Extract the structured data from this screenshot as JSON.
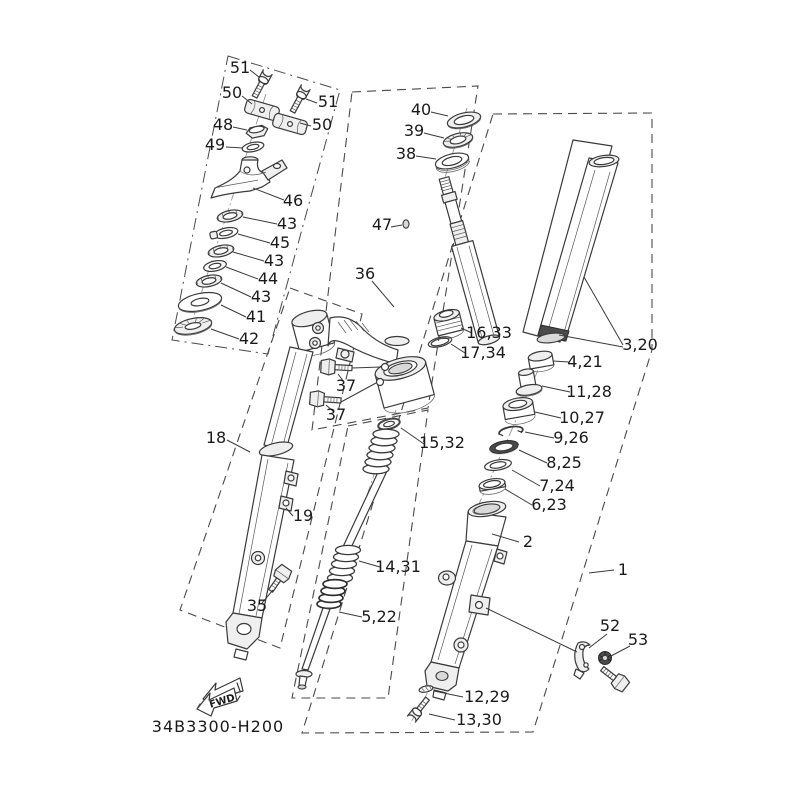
{
  "diagram": {
    "code": "34B3300-H200",
    "fwd_text": "FWD",
    "line_color": "#3a3a3a",
    "label_color": "#1a1a1a",
    "background": "#ffffff",
    "labels": [
      {
        "id": "51-left",
        "text": "51",
        "x": 240,
        "y": 73,
        "leader": [
          250,
          70,
          259,
          77
        ]
      },
      {
        "id": "50-left",
        "text": "50",
        "x": 232,
        "y": 98,
        "leader": [
          242,
          96,
          252,
          104
        ]
      },
      {
        "id": "51-right",
        "text": "51",
        "x": 328,
        "y": 107,
        "leader": [
          317,
          103,
          306,
          99
        ]
      },
      {
        "id": "50-right",
        "text": "50",
        "x": 322,
        "y": 130,
        "leader": [
          311,
          126,
          300,
          123
        ]
      },
      {
        "id": "48",
        "text": "48",
        "x": 223,
        "y": 130,
        "leader": [
          233,
          127,
          247,
          130
        ]
      },
      {
        "id": "49",
        "text": "49",
        "x": 215,
        "y": 150,
        "leader": [
          226,
          147,
          243,
          148
        ]
      },
      {
        "id": "46",
        "text": "46",
        "x": 293,
        "y": 206,
        "leader": [
          284,
          200,
          253,
          188
        ]
      },
      {
        "id": "43-1",
        "text": "43",
        "x": 287,
        "y": 229,
        "leader": [
          277,
          224,
          243,
          217
        ]
      },
      {
        "id": "45",
        "text": "45",
        "x": 280,
        "y": 248,
        "leader": [
          270,
          243,
          238,
          234
        ]
      },
      {
        "id": "43-2",
        "text": "43",
        "x": 274,
        "y": 266,
        "leader": [
          264,
          261,
          233,
          252
        ]
      },
      {
        "id": "44",
        "text": "44",
        "x": 268,
        "y": 284,
        "leader": [
          258,
          279,
          226,
          267
        ]
      },
      {
        "id": "43-3",
        "text": "43",
        "x": 261,
        "y": 302,
        "leader": [
          251,
          297,
          221,
          283
        ]
      },
      {
        "id": "41",
        "text": "41",
        "x": 256,
        "y": 322,
        "leader": [
          246,
          317,
          221,
          305
        ]
      },
      {
        "id": "42",
        "text": "42",
        "x": 249,
        "y": 344,
        "leader": [
          239,
          339,
          211,
          329
        ]
      },
      {
        "id": "18",
        "text": "18",
        "x": 216,
        "y": 443,
        "leader": [
          227,
          440,
          250,
          452
        ]
      },
      {
        "id": "19",
        "text": "19",
        "x": 303,
        "y": 521,
        "leader": [
          293,
          516,
          286,
          508
        ]
      },
      {
        "id": "35",
        "text": "35",
        "x": 257,
        "y": 611,
        "leader": [
          262,
          603,
          273,
          590
        ]
      },
      {
        "id": "36",
        "text": "36",
        "x": 365,
        "y": 279,
        "leader": [
          372,
          281,
          394,
          307
        ]
      },
      {
        "id": "40",
        "text": "40",
        "x": 421,
        "y": 115,
        "leader": [
          431,
          112,
          448,
          116
        ]
      },
      {
        "id": "39",
        "text": "39",
        "x": 414,
        "y": 136,
        "leader": [
          424,
          133,
          444,
          138
        ]
      },
      {
        "id": "38",
        "text": "38",
        "x": 406,
        "y": 159,
        "leader": [
          416,
          156,
          436,
          159
        ]
      },
      {
        "id": "47",
        "text": "47",
        "x": 382,
        "y": 230,
        "leader": [
          391,
          227,
          402,
          225
        ]
      },
      {
        "id": "37-1",
        "text": "37",
        "x": 346,
        "y": 391,
        "leader": [
          344,
          382,
          338,
          374
        ]
      },
      {
        "id": "37-2",
        "text": "37",
        "x": 336,
        "y": 420,
        "leader": [
          334,
          412,
          326,
          405
        ]
      },
      {
        "id": "16-33",
        "text": "16,33",
        "x": 489,
        "y": 338,
        "leader": [
          472,
          333,
          461,
          328
        ]
      },
      {
        "id": "17-34",
        "text": "17,34",
        "x": 483,
        "y": 358,
        "leader": [
          465,
          353,
          451,
          344
        ]
      },
      {
        "id": "15-32",
        "text": "15,32",
        "x": 442,
        "y": 448,
        "leader": [
          424,
          444,
          401,
          428
        ]
      },
      {
        "id": "14-31",
        "text": "14,31",
        "x": 398,
        "y": 572,
        "leader": [
          380,
          567,
          359,
          561
        ]
      },
      {
        "id": "5-22",
        "text": "5,22",
        "x": 379,
        "y": 622,
        "leader": [
          362,
          617,
          339,
          612
        ]
      },
      {
        "id": "3-20",
        "text": "3,20",
        "x": 640,
        "y": 350,
        "leader": [
          623,
          345,
          584,
          277
        ],
        "leader2": [
          623,
          347,
          559,
          335
        ]
      },
      {
        "id": "4-21",
        "text": "4,21",
        "x": 585,
        "y": 367,
        "leader": [
          569,
          362,
          553,
          361
        ]
      },
      {
        "id": "11-28",
        "text": "11,28",
        "x": 589,
        "y": 397,
        "leader": [
          570,
          392,
          542,
          386
        ]
      },
      {
        "id": "10-27",
        "text": "10,27",
        "x": 582,
        "y": 423,
        "leader": [
          561,
          418,
          535,
          412
        ]
      },
      {
        "id": "9-26",
        "text": "9,26",
        "x": 571,
        "y": 443,
        "leader": [
          554,
          438,
          525,
          432
        ]
      },
      {
        "id": "8-25",
        "text": "8,25",
        "x": 564,
        "y": 468,
        "leader": [
          547,
          463,
          519,
          450
        ]
      },
      {
        "id": "7-24",
        "text": "7,24",
        "x": 557,
        "y": 491,
        "leader": [
          540,
          486,
          512,
          470
        ]
      },
      {
        "id": "6-23",
        "text": "6,23",
        "x": 549,
        "y": 510,
        "leader": [
          532,
          505,
          505,
          489
        ]
      },
      {
        "id": "2",
        "text": "2",
        "x": 528,
        "y": 547,
        "leader": [
          519,
          542,
          492,
          534
        ]
      },
      {
        "id": "1",
        "text": "1",
        "x": 623,
        "y": 575,
        "leader": [
          614,
          570,
          589,
          573
        ]
      },
      {
        "id": "12-29",
        "text": "12,29",
        "x": 487,
        "y": 702,
        "leader": [
          463,
          697,
          434,
          691
        ]
      },
      {
        "id": "13-30",
        "text": "13,30",
        "x": 479,
        "y": 725,
        "leader": [
          455,
          720,
          429,
          714
        ]
      },
      {
        "id": "52",
        "text": "52",
        "x": 610,
        "y": 631,
        "leader": [
          607,
          634,
          589,
          648
        ]
      },
      {
        "id": "53",
        "text": "53",
        "x": 638,
        "y": 645,
        "leader": [
          630,
          646,
          611,
          656
        ]
      },
      {
        "id": "code",
        "text": "34B3300-H200",
        "x": 218,
        "y": 732,
        "size": 16,
        "spacing": 1
      },
      {
        "id": "fwd",
        "text": "FWD",
        "x": 223,
        "y": 704,
        "size": 10,
        "bold": true,
        "rotate": -17
      }
    ]
  }
}
